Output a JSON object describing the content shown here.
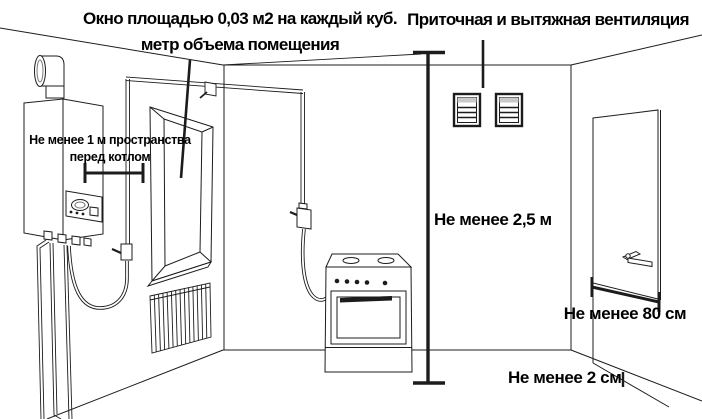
{
  "titles": {
    "window_rule_line1": "Окно площадью 0,03 м2 на каждый куб.",
    "window_rule_line2": "метр объема помещения",
    "ventilation_rule": "Приточная и вытяжная вентиляция"
  },
  "labels": {
    "boiler_clearance_line1": "Не менее 1 м пространства",
    "boiler_clearance_line2": "перед котлом",
    "ceiling_height_min": "Не менее 2,5 м",
    "door_width_min": "Не менее 80 см",
    "door_gap_min": "Не менее 2 см"
  },
  "colors": {
    "line": "#1c1c1c",
    "text": "#000000",
    "background": "#ffffff"
  }
}
